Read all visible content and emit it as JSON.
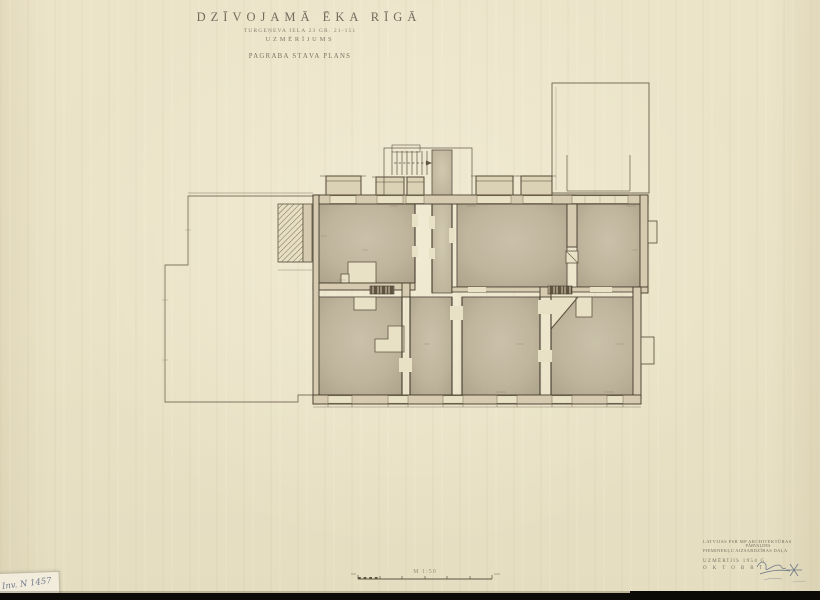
{
  "document": {
    "title": "DZĪVOJAMĀ ĒKA RĪGĀ",
    "subtitle": "TURGEŅEVA IELA 23   GR. 21-151",
    "survey_type": "UZMĒRĪJUMS",
    "plan_name": "PAGRABA STĀVA PLĀNS"
  },
  "scale": {
    "label": "M 1:50"
  },
  "stamp": {
    "org_line1": "LATVIJAS PSR MP ARCHITEKTŪRAS",
    "org_line2": "PĀRVALDES",
    "org_line3": "PIEMINEKĻU AIZSARDZĪBAS DAĻA",
    "measured_line": "UZMĒRĪJIS 1954 G.",
    "month_line": "O K T O B R Ī"
  },
  "inventory": {
    "label": "Inv. N 1457"
  },
  "colors": {
    "paper": "#ebe3c7",
    "room_wash": "#bcb199",
    "wall_fill": "#d6cbb0",
    "line_dark": "#443a2c",
    "line_thin": "#6f6250",
    "black_bar": "#0b0a07",
    "signature_ink": "#51617a"
  }
}
